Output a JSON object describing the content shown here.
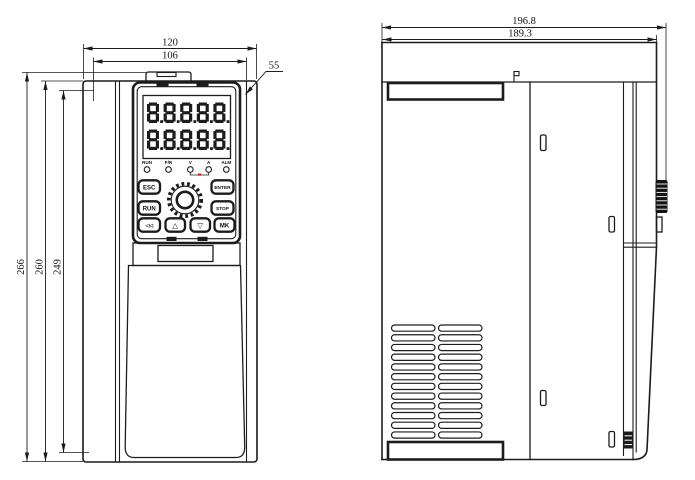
{
  "front_view": {
    "dimensions": {
      "top_outer_width": "120",
      "top_inner_width": "106",
      "keypad_leader": "55",
      "left_outer_height": "266",
      "left_mid_height": "260",
      "left_inner_height": "249"
    },
    "keypad": {
      "display_rows": [
        "8.8.8.8.8.",
        "8.8.8.8.8."
      ],
      "indicators": [
        "RUN",
        "F/R",
        "V",
        "A",
        "ALM"
      ],
      "buttons": {
        "esc": "ESC",
        "enter": "ENTER",
        "run": "RUN",
        "stop": "STOP",
        "back": "◁◁",
        "up": "△",
        "down": "▽",
        "mk": "MK"
      }
    }
  },
  "side_view": {
    "dimensions": {
      "top_outer_depth": "196.8",
      "top_inner_depth": "189.3"
    }
  },
  "colors": {
    "line": "#1c1c1c",
    "indicator_red": "#cc2222"
  }
}
